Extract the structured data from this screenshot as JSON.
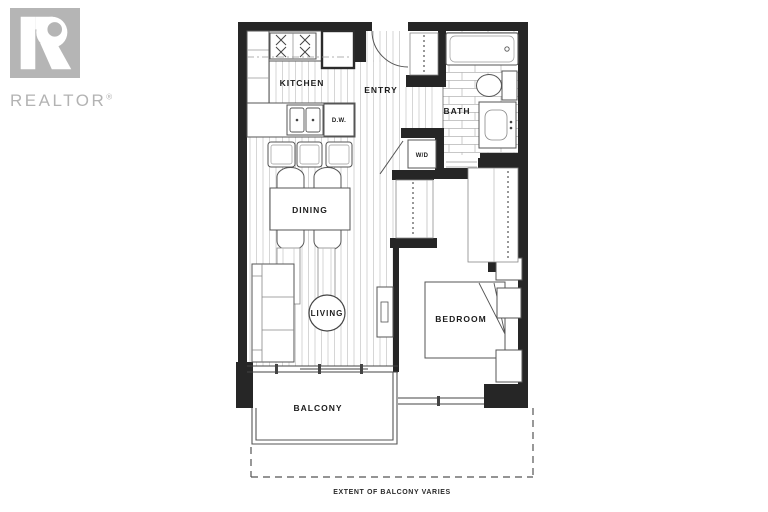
{
  "branding": {
    "logo_name": "REALTOR",
    "registered": "®"
  },
  "floorplan": {
    "labels": {
      "kitchen": "KITCHEN",
      "entry": "ENTRY",
      "bath": "BATH",
      "washer_dryer": "W/D",
      "dishwasher": "D.W.",
      "dining": "DINING",
      "living": "LIVING",
      "bedroom": "BEDROOM",
      "balcony": "BALCONY",
      "balcony_note": "EXTENT OF BALCONY VARIES"
    },
    "colors": {
      "walls": "#262626",
      "fixture_lines": "#555555",
      "floor_lines": "#cccccc",
      "tile_lines": "#b5b5b5",
      "logo_gray": "#b5b5b5",
      "background": "#ffffff"
    }
  }
}
